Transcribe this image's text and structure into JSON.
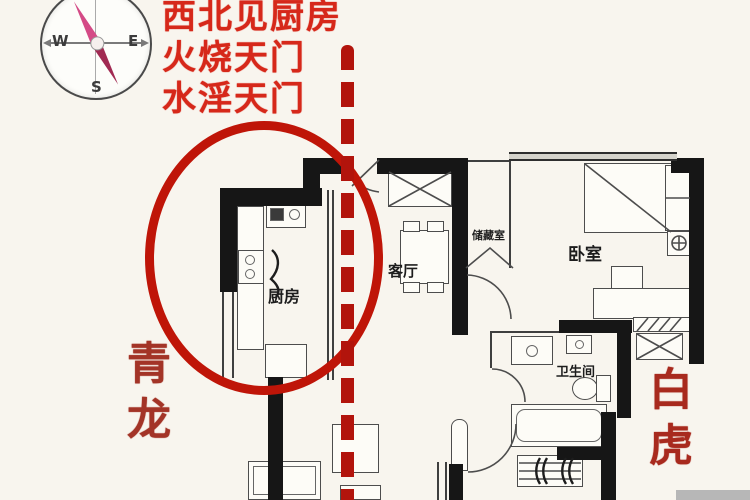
{
  "title_annotations": {
    "line1": "西北见厨房",
    "line2": "火烧天门",
    "line3": "水淫天门"
  },
  "compass": {
    "north": "N",
    "south": "S",
    "west": "W",
    "east": "E"
  },
  "feng_shui_labels": {
    "left": "青龙",
    "right": "白虎"
  },
  "floor_plan": {
    "rooms": {
      "kitchen": "厨房",
      "living_room": "客厅",
      "storage": "储藏室",
      "bedroom": "卧室",
      "bathroom": "卫生间"
    }
  },
  "colors": {
    "annotation_red": "#d6281a",
    "circle_red": "#bf1508",
    "dash_red": "#b2140c",
    "dragon_label_red": "#a33427",
    "tiger_label_red": "#a82a1e",
    "wall_black": "#161616",
    "background_cream": "#f8f5ee",
    "needle_pink": "#d44a86"
  }
}
